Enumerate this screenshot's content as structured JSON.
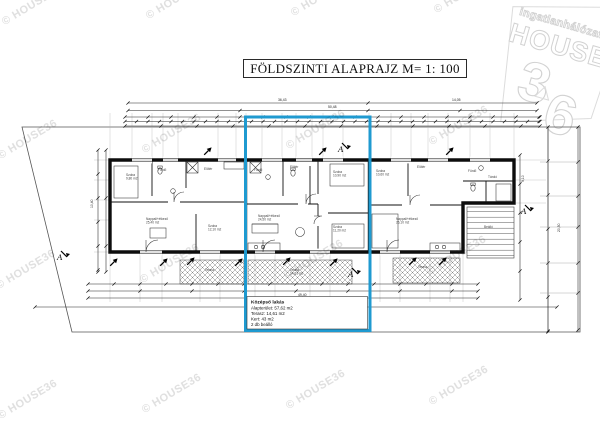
{
  "watermark": {
    "text": "© HOUSE36",
    "color": "#e0e0e0"
  },
  "logo": {
    "network_label": "ingatlanhálózat",
    "brand": "HOUSE",
    "digit_three": "3",
    "digit_six": "6",
    "color": "#d6d6d6"
  },
  "title_box": {
    "text": "FÖLDSZINTI ALAPRAJZ M= 1: 100"
  },
  "highlight_note": {
    "title": "Középső lakás",
    "lines": [
      "Alapterület: 57,62 m2",
      "Terasz: 14,61 m2",
      "Kert: 43 m2",
      "2 db beálló"
    ]
  },
  "plan": {
    "section_label": "A",
    "colors": {
      "highlight_blue": "#1f9ad0",
      "wall_black": "#0d0d0d",
      "dim_line": "#222222",
      "watermark_gray": "#e0e0e0"
    },
    "section_markers": [
      {
        "x": 338,
        "y": 152
      },
      {
        "x": 348,
        "y": 277
      },
      {
        "x": 57,
        "y": 260
      },
      {
        "x": 521,
        "y": 214
      }
    ],
    "room_labels": [
      {
        "x": 126,
        "y": 176,
        "name": "Szoba",
        "area": "9,80 m2"
      },
      {
        "x": 158,
        "y": 171,
        "name": "Fürdő",
        "area": ""
      },
      {
        "x": 204,
        "y": 170,
        "name": "Előtér",
        "area": ""
      },
      {
        "x": 146,
        "y": 220,
        "name": "Nappali+étkező",
        "area": "25,40 m2"
      },
      {
        "x": 208,
        "y": 227,
        "name": "Szoba",
        "area": "12,10 m2"
      },
      {
        "x": 254,
        "y": 171,
        "name": "Fürdő",
        "area": ""
      },
      {
        "x": 290,
        "y": 168,
        "name": "Előtér",
        "area": ""
      },
      {
        "x": 333,
        "y": 173,
        "name": "Szoba",
        "area": "10,90 m2"
      },
      {
        "x": 258,
        "y": 217,
        "name": "Nappali+étkező",
        "area": "24,50 m2"
      },
      {
        "x": 333,
        "y": 228,
        "name": "Szoba",
        "area": "11,20 m2"
      },
      {
        "x": 376,
        "y": 172,
        "name": "Szoba",
        "area": "10,60 m2"
      },
      {
        "x": 417,
        "y": 168,
        "name": "Előtér",
        "area": ""
      },
      {
        "x": 468,
        "y": 172,
        "name": "Fürdő",
        "area": ""
      },
      {
        "x": 488,
        "y": 178,
        "name": "Tároló",
        "area": ""
      },
      {
        "x": 396,
        "y": 220,
        "name": "Nappali+étkező",
        "area": "26,10 m2"
      },
      {
        "x": 205,
        "y": 271,
        "name": "Terasz",
        "area": ""
      },
      {
        "x": 290,
        "y": 271,
        "name": "Terasz",
        "area": "14,61 m2"
      },
      {
        "x": 418,
        "y": 268,
        "name": "Terasz",
        "area": ""
      },
      {
        "x": 484,
        "y": 228,
        "name": "Beálló",
        "area": ""
      }
    ],
    "dim_labels": [
      {
        "x": 278,
        "y": 101,
        "text": "36,43",
        "rot": 0
      },
      {
        "x": 452,
        "y": 101,
        "text": "14,05",
        "rot": 0
      },
      {
        "x": 328,
        "y": 108,
        "text": "50,48",
        "rot": 0
      },
      {
        "x": 298,
        "y": 296,
        "text": "49,40",
        "rot": 0
      },
      {
        "x": 93,
        "y": 208,
        "text": "10,40",
        "rot": -90
      },
      {
        "x": 560,
        "y": 232,
        "text": "20,50",
        "rot": -90
      },
      {
        "x": 524,
        "y": 182,
        "text": "9,10",
        "rot": -90
      }
    ]
  }
}
